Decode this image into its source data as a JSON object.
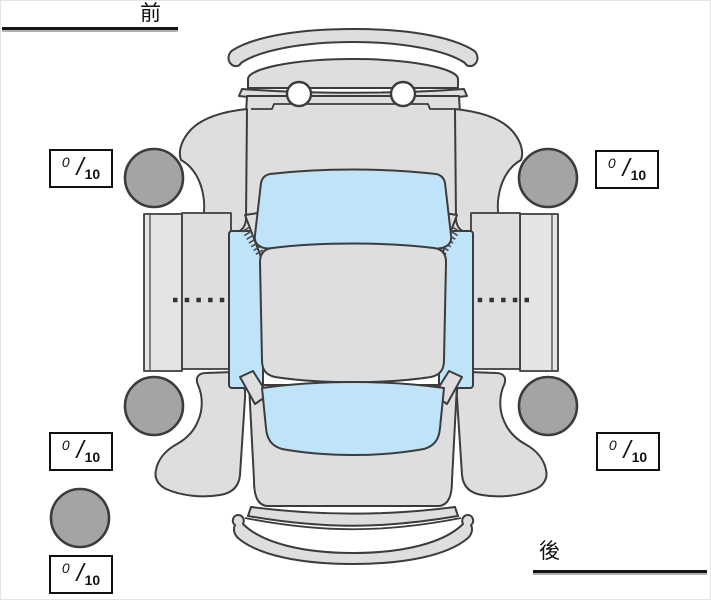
{
  "labels": {
    "front": "前",
    "rear": "後"
  },
  "score_separator": "/",
  "scores": {
    "front_left": {
      "value": "0",
      "max": "10"
    },
    "front_right": {
      "value": "0",
      "max": "10"
    },
    "rear_left": {
      "value": "0",
      "max": "10"
    },
    "rear_right": {
      "value": "0",
      "max": "10"
    },
    "spare": {
      "value": "0",
      "max": "10"
    }
  },
  "diagram": {
    "type": "car-top-view",
    "tire_count": 4,
    "spare_tire": true,
    "icons": {
      "tires": "tire-icon",
      "spare": "spare-tire-icon",
      "mirror_hatch": "door-mirror-hatch-icon"
    },
    "colors": {
      "body": "#dedede",
      "panel": "#e4e4e4",
      "window": "#bfe3f8",
      "tire": "#a4a4a4",
      "outline": "#3c3c3c",
      "text": "#111111"
    }
  }
}
